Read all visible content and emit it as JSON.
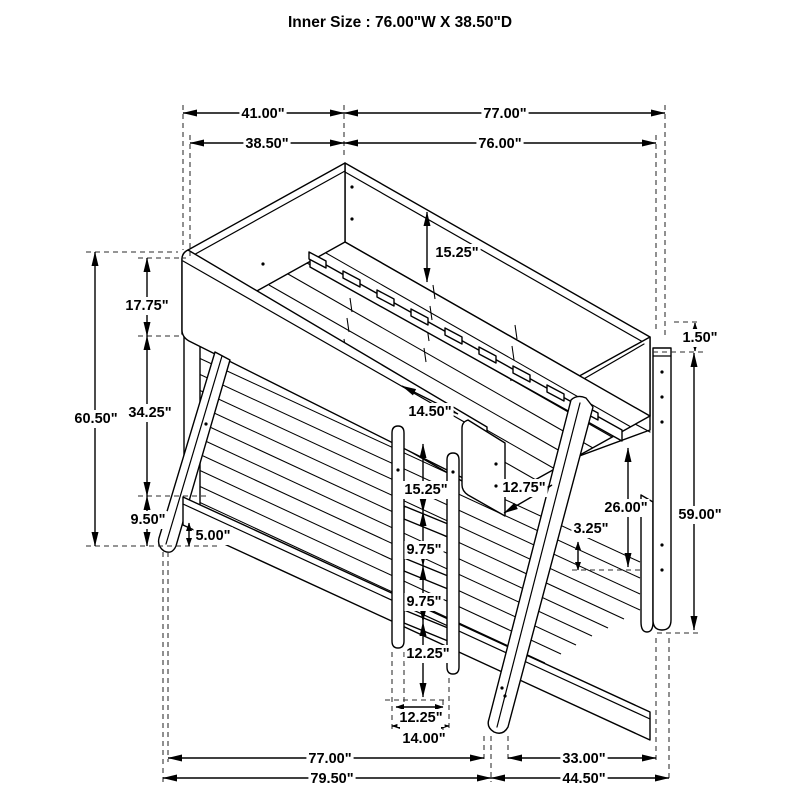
{
  "page": {
    "background": "#ffffff",
    "line_color": "#000000"
  },
  "title": "Inner Size : 76.00\"W X  38.50\"D",
  "dims": {
    "top_depth_overall": "41.00\"",
    "top_width_overall": "77.00\"",
    "top_depth_inner": "38.50\"",
    "top_width_inner": "76.00\"",
    "overall_height_left": "60.50\"",
    "left_upper_section": "17.75\"",
    "left_middle_section": "34.25\"",
    "left_lower_section": "9.50\"",
    "floor_clearance": "5.00\"",
    "upper_rail_height": "15.25\"",
    "rail_to_panel_gap": "14.50\"",
    "ladder_top_spacing": "15.25\"",
    "rung_spacing_upper": "9.75\"",
    "rung_spacing_lower": "9.75\"",
    "ladder_bottom_spacing": "12.25\"",
    "ladder_inner_width": "12.25\"",
    "ladder_outer_width": "14.00\"",
    "panel_leg_gap": "12.75\"",
    "deck_thickness": "3.25\"",
    "bunk_clearance": "26.00\"",
    "overall_height_right": "59.00\"",
    "rail_top_offset": "1.50\"",
    "bottom_width": "77.00\"",
    "bottom_right_depth": "33.00\"",
    "bottom_width_overall": "79.50\"",
    "bottom_depth_overall": "44.50\""
  }
}
